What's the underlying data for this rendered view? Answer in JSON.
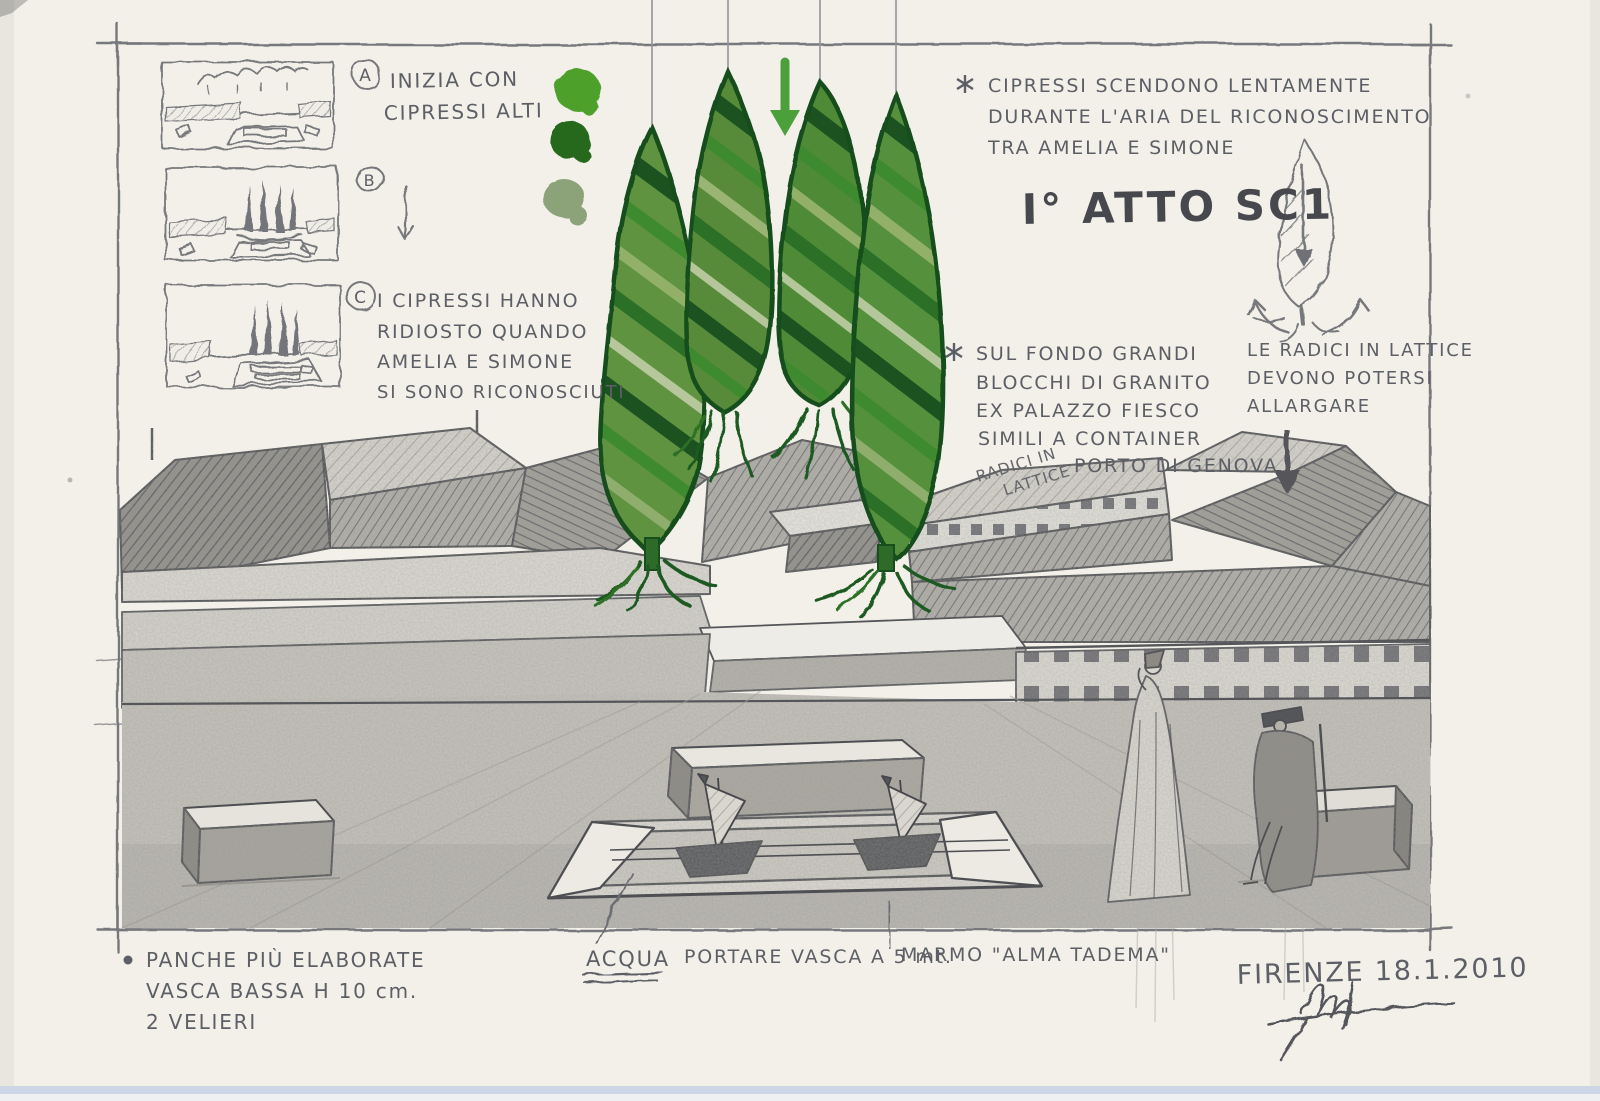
{
  "storyboard": {
    "a_label": "A",
    "b_label": "B",
    "c_label": "C",
    "a_note_1": "INIZIA CON",
    "a_note_2": "CIPRESSI ALTI",
    "c_note_1": "I CIPRESSI HANNO",
    "c_note_2": "RIDIOSTO QUANDO",
    "c_note_3": "AMELIA E SIMONE",
    "c_note_4": "SI SONO RICONOSCIUTI"
  },
  "notes": {
    "descent_1": "CIPRESSI SCENDONO LENTAMENTE",
    "descent_2": "DURANTE L'ARIA DEL RICONOSCIMENTO",
    "descent_3": "TRA AMELIA E SIMONE",
    "act_title": "I° ATTO SC1",
    "granite_1": "SUL FONDO GRANDI",
    "granite_2": "BLOCCHI DI GRANITO",
    "granite_3": "EX PALAZZO FIESCO",
    "granite_4": "SIMILI A CONTAINER",
    "granite_5": "PORTO DI GENOVA",
    "roots_tag_1": "RADICI IN",
    "roots_tag_2": "LATTICE",
    "roots_note_1": "LE RADICI IN LATTICE",
    "roots_note_2": "DEVONO POTERSI",
    "roots_note_3": "ALLARGARE"
  },
  "footer": {
    "panche_1": "PANCHE PIÙ ELABORATE",
    "panche_2": "VASCA BASSA H 10 cm.",
    "panche_3": "2 VELIERI",
    "acqua": "ACQUA",
    "portare": "PORTARE VASCA A 5 mt.",
    "marmo": "MARMO \"ALMA TADEMA\"",
    "place_date": "FIRENZE 18.1.2010"
  },
  "colors": {
    "swatch_bright": "#4da12c",
    "swatch_dark": "#27691f",
    "swatch_sage": "#8ca37a",
    "marker_green": "#3f9a2e",
    "graphite": "#5d5f66"
  }
}
